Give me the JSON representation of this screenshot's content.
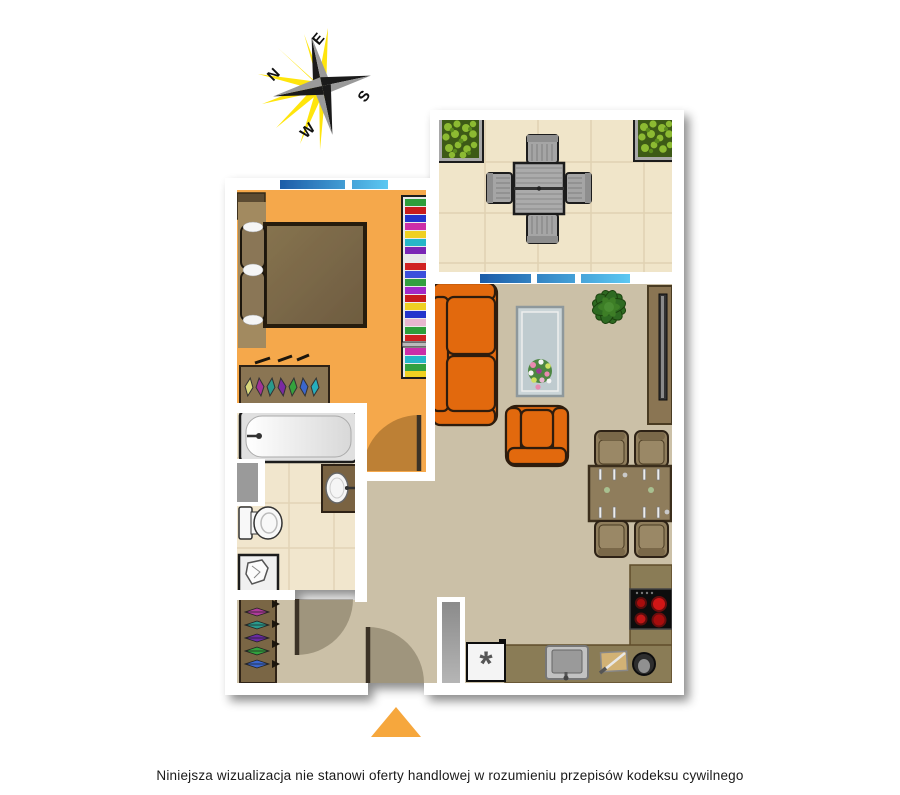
{
  "compass": {
    "north": "N",
    "east": "E",
    "south": "S",
    "west": "W"
  },
  "kitchen": {
    "freezer_symbol": "*"
  },
  "footer": {
    "disclaimer": "Niniejsza wizualizacja nie stanowi oferty handlowej w rozumieniu przepisów kodeksu cywilnego"
  },
  "colors": {
    "bedroom_floor": "#F5A84B",
    "living_floor": "#CBC0A7",
    "bathroom_floor": "#F1E6CD",
    "balcony_floor": "#F0E5C9",
    "wall": "#FFFFFF",
    "sofa_orange": "#E2690E",
    "kitchen_counter": "#8A7B57",
    "wood_furniture": "#8F7D5C",
    "window_blue_dark": "#1C5CA8",
    "window_blue_light": "#5CC8F2",
    "stove_burner_red": "#D01818",
    "entrance_arrow": "#F6A73D",
    "compass_ray_yellow": "#FFE400"
  }
}
